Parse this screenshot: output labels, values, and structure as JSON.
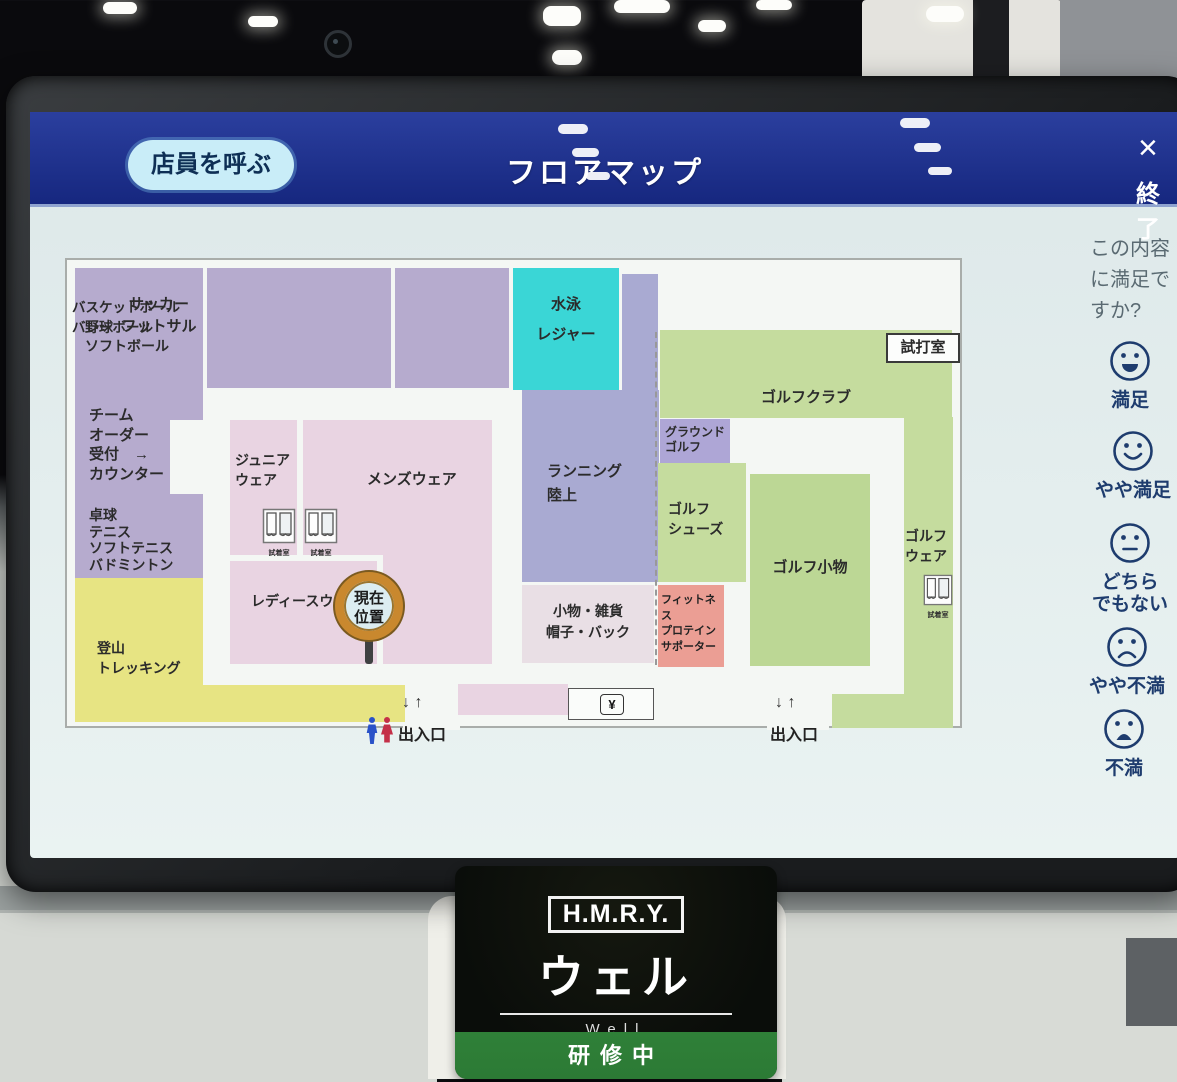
{
  "header": {
    "call_staff_button": "店員を呼ぶ",
    "title": "フロアマップ",
    "close_icon": "×",
    "end_label": "終了"
  },
  "map": {
    "areas": {
      "baseball": "野球\nソフトボール",
      "team_order": "チーム\nオーダー\n受付　→\nカウンター",
      "table_tennis": "卓球\nテニス\nソフトテニス\nバドミントン",
      "soccer": "サッカー\nフットサル",
      "basketball": "バスケットボール\nバレーボール",
      "swimming": "水泳\nレジャー",
      "running": "ランニング\n陸上",
      "junior_wear": "ジュニア\nウェア",
      "mens_wear": "メンズウェア",
      "ladies_wear": "レディースウェア",
      "accessories": "小物・雑貨\n帽子・バック",
      "trekking": "登山\nトレッキング",
      "fitness": "フィットネス\nプロテイン\nサポーター",
      "golf_club": "ゴルフクラブ",
      "ground_golf": "グラウンド\nゴルフ",
      "golf_shoes": "ゴルフ\nシューズ",
      "golf_accessories": "ゴルフ小物",
      "golf_wear": "ゴルフ\nウェア",
      "trial_room": "試打室"
    },
    "fitting_room_label": "試着室",
    "current_location": "現在\n位置",
    "exit_label": "出入口",
    "exit_arrows": "↓ ↑",
    "register_symbol": "¥"
  },
  "survey": {
    "question": "この内容に満足ですか?",
    "options": [
      {
        "label": "満足",
        "face": "smile-open"
      },
      {
        "label": "やや満足",
        "face": "smile"
      },
      {
        "label": "どちら\nでもない",
        "face": "neutral"
      },
      {
        "label": "やや不満",
        "face": "frown"
      },
      {
        "label": "不満",
        "face": "frown-open"
      }
    ]
  },
  "badge": {
    "brand": "H.M.R.Y.",
    "name_jp": "ウェル",
    "name_en": "Well",
    "status": "研修中"
  },
  "colors": {
    "header-blue": "#20339a",
    "call-btn": "#c9edf8",
    "lavender": "#b6abce",
    "cyan": "#3ad6d6",
    "pink": "#e9d4e2",
    "pale-pink": "#e9dfe5",
    "yellow": "#e7e483",
    "salmon": "#eb9e94",
    "green": "#c5dc9e",
    "green-dark": "#bcd795",
    "running-purple": "#a9aad2",
    "ground-purple": "#aea6d6",
    "marker-ring": "#c9882e",
    "survey-navy": "#1e3c6e",
    "badge-green": "#2c7a35",
    "map-bg": "#f4f7f4"
  }
}
